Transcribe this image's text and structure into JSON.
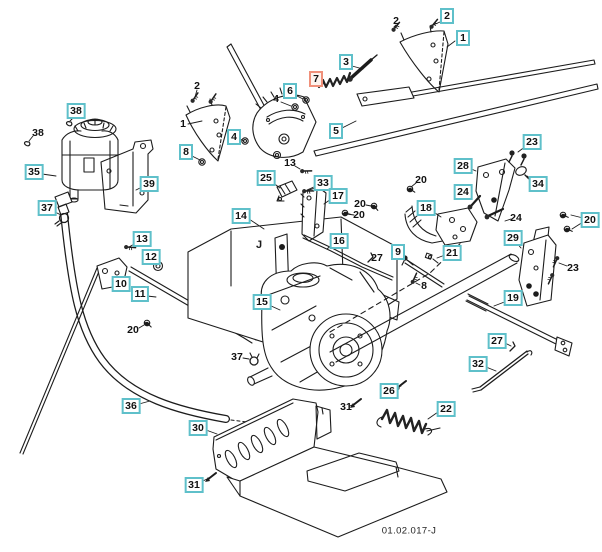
{
  "page": {
    "background_color": "#ffffff",
    "drawing_number": "01.02.017-J"
  },
  "diagram": {
    "plate_letter": "J",
    "styles": {
      "callout_border": "#5fc0ca",
      "callout_background": "#ffffff",
      "callout_text": "#111111",
      "highlight_border": "#f0907a",
      "highlight_background": "#fdf4ef",
      "line_color": "#1c1c1c"
    },
    "callouts": [
      {
        "label": "2",
        "x": 447,
        "y": 16,
        "variant": "boxed"
      },
      {
        "label": "1",
        "x": 463,
        "y": 38,
        "variant": "boxed"
      },
      {
        "label": "3",
        "x": 346,
        "y": 62,
        "variant": "boxed"
      },
      {
        "label": "7",
        "x": 316,
        "y": 79,
        "variant": "highlight"
      },
      {
        "label": "6",
        "x": 290,
        "y": 91,
        "variant": "boxed"
      },
      {
        "label": "5",
        "x": 336,
        "y": 131,
        "variant": "boxed"
      },
      {
        "label": "4",
        "x": 234,
        "y": 137,
        "variant": "boxed"
      },
      {
        "label": "8",
        "x": 186,
        "y": 152,
        "variant": "boxed"
      },
      {
        "label": "38",
        "x": 76,
        "y": 111,
        "variant": "boxed"
      },
      {
        "label": "35",
        "x": 34,
        "y": 172,
        "variant": "boxed"
      },
      {
        "label": "39",
        "x": 149,
        "y": 184,
        "variant": "boxed"
      },
      {
        "label": "37",
        "x": 47,
        "y": 208,
        "variant": "boxed"
      },
      {
        "label": "13",
        "x": 142,
        "y": 239,
        "variant": "boxed"
      },
      {
        "label": "12",
        "x": 151,
        "y": 257,
        "variant": "boxed"
      },
      {
        "label": "10",
        "x": 121,
        "y": 284,
        "variant": "boxed"
      },
      {
        "label": "11",
        "x": 140,
        "y": 294,
        "variant": "boxed"
      },
      {
        "label": "25",
        "x": 266,
        "y": 178,
        "variant": "boxed"
      },
      {
        "label": "33",
        "x": 323,
        "y": 183,
        "variant": "boxed"
      },
      {
        "label": "17",
        "x": 338,
        "y": 196,
        "variant": "boxed"
      },
      {
        "label": "14",
        "x": 241,
        "y": 216,
        "variant": "boxed"
      },
      {
        "label": "16",
        "x": 339,
        "y": 241,
        "variant": "boxed"
      },
      {
        "label": "15",
        "x": 262,
        "y": 302,
        "variant": "boxed"
      },
      {
        "label": "23",
        "x": 532,
        "y": 142,
        "variant": "boxed"
      },
      {
        "label": "28",
        "x": 463,
        "y": 166,
        "variant": "boxed"
      },
      {
        "label": "34",
        "x": 538,
        "y": 184,
        "variant": "boxed"
      },
      {
        "label": "24",
        "x": 463,
        "y": 192,
        "variant": "boxed"
      },
      {
        "label": "18",
        "x": 426,
        "y": 208,
        "variant": "boxed"
      },
      {
        "label": "20",
        "x": 590,
        "y": 220,
        "variant": "boxed"
      },
      {
        "label": "29",
        "x": 513,
        "y": 238,
        "variant": "boxed"
      },
      {
        "label": "9",
        "x": 398,
        "y": 252,
        "variant": "boxed"
      },
      {
        "label": "21",
        "x": 452,
        "y": 253,
        "variant": "boxed"
      },
      {
        "label": "19",
        "x": 513,
        "y": 298,
        "variant": "boxed"
      },
      {
        "label": "27",
        "x": 497,
        "y": 341,
        "variant": "boxed"
      },
      {
        "label": "32",
        "x": 478,
        "y": 364,
        "variant": "boxed"
      },
      {
        "label": "26",
        "x": 389,
        "y": 391,
        "variant": "boxed"
      },
      {
        "label": "22",
        "x": 446,
        "y": 409,
        "variant": "boxed"
      },
      {
        "label": "36",
        "x": 131,
        "y": 406,
        "variant": "boxed"
      },
      {
        "label": "30",
        "x": 198,
        "y": 428,
        "variant": "boxed"
      },
      {
        "label": "31",
        "x": 194,
        "y": 485,
        "variant": "boxed"
      },
      {
        "label": "2",
        "x": 396,
        "y": 21,
        "variant": "plain"
      },
      {
        "label": "2",
        "x": 197,
        "y": 86,
        "variant": "plain"
      },
      {
        "label": "1",
        "x": 183,
        "y": 124,
        "variant": "plain"
      },
      {
        "label": "4",
        "x": 276,
        "y": 99,
        "variant": "plain"
      },
      {
        "label": "38",
        "x": 38,
        "y": 133,
        "variant": "plain"
      },
      {
        "label": "13",
        "x": 290,
        "y": 163,
        "variant": "plain"
      },
      {
        "label": "20",
        "x": 421,
        "y": 180,
        "variant": "plain"
      },
      {
        "label": "20",
        "x": 360,
        "y": 204,
        "variant": "plain"
      },
      {
        "label": "20",
        "x": 359,
        "y": 215,
        "variant": "plain"
      },
      {
        "label": "24",
        "x": 516,
        "y": 218,
        "variant": "plain"
      },
      {
        "label": "27",
        "x": 377,
        "y": 258,
        "variant": "plain"
      },
      {
        "label": "23",
        "x": 573,
        "y": 268,
        "variant": "plain"
      },
      {
        "label": "8",
        "x": 424,
        "y": 286,
        "variant": "plain"
      },
      {
        "label": "20",
        "x": 133,
        "y": 330,
        "variant": "plain"
      },
      {
        "label": "37",
        "x": 237,
        "y": 357,
        "variant": "plain"
      },
      {
        "label": "31",
        "x": 346,
        "y": 407,
        "variant": "plain"
      }
    ]
  }
}
